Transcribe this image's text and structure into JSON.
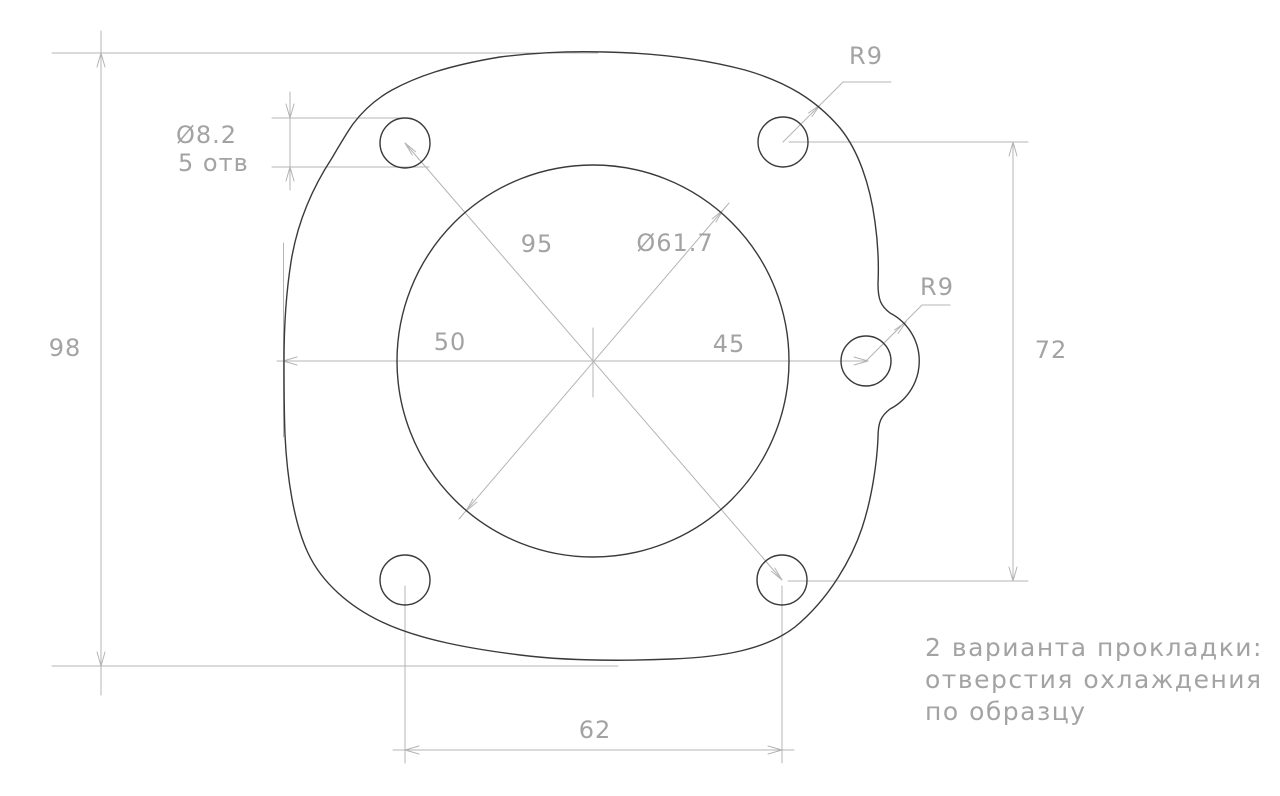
{
  "drawing": {
    "labels": {
      "overall_height": "98",
      "hole_diameter": "Ø8.2",
      "hole_count": "5 отв",
      "bolt_circle": "95",
      "center_circle_diameter": "Ø61.7",
      "center_to_left_edge": "50",
      "center_to_side_hole": "45",
      "side_holes_spacing": "72",
      "bottom_holes_spacing": "62",
      "top_corner_radius": "R9",
      "side_boss_radius": "R9"
    },
    "note": {
      "line1": "2 варианта прокладки:",
      "line2": "отверстия охлаждения",
      "line3": "по образцу"
    },
    "colors": {
      "background": "#ffffff",
      "outline": "#3a3a3a",
      "dimension_lines": "#b4b4b4",
      "dimension_text": "#a3a3a3"
    }
  }
}
